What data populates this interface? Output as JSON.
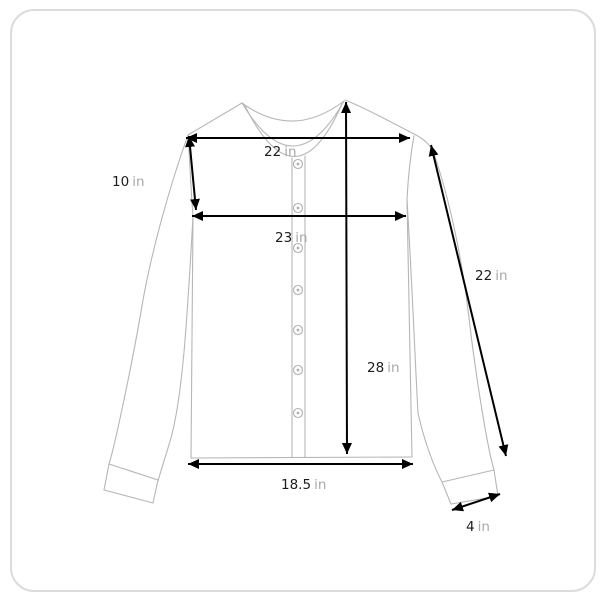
{
  "diagram": {
    "measurements": {
      "shoulder_width": {
        "value": "22",
        "unit": "in"
      },
      "armhole_depth": {
        "value": "10",
        "unit": "in"
      },
      "chest_width": {
        "value": "23",
        "unit": "in"
      },
      "sleeve_length": {
        "value": "22",
        "unit": "in"
      },
      "body_length": {
        "value": "28",
        "unit": "in"
      },
      "hem_width": {
        "value": "18.5",
        "unit": "in"
      },
      "cuff_width": {
        "value": "4",
        "unit": "in"
      }
    },
    "colors": {
      "measure_line": "#000000",
      "value_text": "#1c1c1c",
      "unit_text": "#a8a8a8",
      "garment_outline": "#b6b6b6",
      "frame_border": "#dcdcdc"
    }
  }
}
